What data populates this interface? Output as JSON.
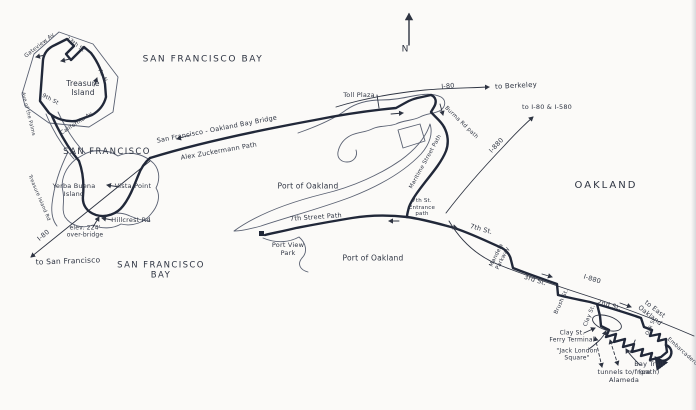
{
  "colors": {
    "paper": "#fbfaf8",
    "ink": "#2e3442",
    "route": "#212839",
    "thin": "#5a6172"
  },
  "map": {
    "type": "hand-drawn bicycle route map, SF Bay Bridge / Oakland",
    "labels": [
      {
        "name": "sf-bay-north",
        "text": "SAN FRANCISCO BAY",
        "x": 203,
        "y": 60,
        "rot": 0,
        "size": 9,
        "ls": 1.6
      },
      {
        "name": "san-francisco",
        "text": "SAN FRANCISCO",
        "x": 107,
        "y": 152,
        "rot": 0,
        "size": 8.5,
        "ls": 1.4
      },
      {
        "name": "sf-bay-south",
        "text": "SAN FRANCISCO\nBAY",
        "x": 161,
        "y": 271,
        "rot": 0,
        "size": 8.5,
        "ls": 1.4
      },
      {
        "name": "oakland",
        "text": "OAKLAND",
        "x": 606,
        "y": 186,
        "rot": 0,
        "size": 10,
        "ls": 2
      },
      {
        "name": "port-of-oakland-upper",
        "text": "Port of Oakland",
        "x": 308,
        "y": 186,
        "rot": 0,
        "size": 7.5
      },
      {
        "name": "port-of-oakland-lower",
        "text": "Port of Oakland",
        "x": 373,
        "y": 258,
        "rot": 0,
        "size": 7.5
      },
      {
        "name": "treasure-island",
        "text": "Treasure\nIsland",
        "x": 83,
        "y": 88,
        "rot": 0,
        "size": 7.5
      },
      {
        "name": "gateview-av",
        "text": "Gateview Av",
        "x": 40,
        "y": 46,
        "rot": -38,
        "size": 5.5
      },
      {
        "name": "thirteenth-st",
        "text": "13th St",
        "x": 75,
        "y": 45,
        "rot": 36,
        "size": 5.5
      },
      {
        "name": "av-n",
        "text": "Av N",
        "x": 102,
        "y": 76,
        "rot": 62,
        "size": 5.5
      },
      {
        "name": "ninth-st",
        "text": "9th St",
        "x": 50,
        "y": 100,
        "rot": 28,
        "size": 5.5
      },
      {
        "name": "california-av",
        "text": "California Av",
        "x": 77,
        "y": 124,
        "rot": -33,
        "size": 5.5
      },
      {
        "name": "ave-of-the-palms",
        "text": "Ave of the Palms",
        "x": 28,
        "y": 114,
        "rot": 76,
        "size": 5
      },
      {
        "name": "treasure-island-rd",
        "text": "Treasure Island Rd",
        "x": 39,
        "y": 198,
        "rot": 67,
        "size": 5
      },
      {
        "name": "yerba-buena-island",
        "text": "Yerba Buena\nIsland",
        "x": 74,
        "y": 191,
        "rot": 0,
        "size": 6.5
      },
      {
        "name": "vista-point",
        "text": "Vista Point",
        "x": 133,
        "y": 187,
        "rot": 0,
        "size": 6.5
      },
      {
        "name": "hillcrest-rd",
        "text": "Hillcrest Rd",
        "x": 131,
        "y": 221,
        "rot": 0,
        "size": 6.5
      },
      {
        "name": "elevation",
        "text": "elev. 224'\nover-bridge",
        "x": 85,
        "y": 232,
        "rot": 0,
        "size": 6
      },
      {
        "name": "i80-west",
        "text": "I-80",
        "x": 44,
        "y": 236,
        "rot": -40,
        "size": 6.5
      },
      {
        "name": "to-san-francisco",
        "text": "to San Francisco",
        "x": 68,
        "y": 261,
        "rot": -2,
        "size": 7.5
      },
      {
        "name": "bay-bridge",
        "text": "San Francisco - Oakland Bay Bridge",
        "x": 217,
        "y": 130,
        "rot": -11,
        "size": 6.5
      },
      {
        "name": "zuckermann-path",
        "text": "Alex Zuckermann Path",
        "x": 219,
        "y": 152,
        "rot": -10,
        "size": 6.5
      },
      {
        "name": "toll-plaza",
        "text": "Toll Plaza",
        "x": 359,
        "y": 96,
        "rot": 0,
        "size": 6.5
      },
      {
        "name": "i80-east",
        "text": "I-80",
        "x": 448,
        "y": 87,
        "rot": -5,
        "size": 6.5
      },
      {
        "name": "to-berkeley",
        "text": "to Berkeley",
        "x": 516,
        "y": 86,
        "rot": -3,
        "size": 7
      },
      {
        "name": "to-i80-i580",
        "text": "to I-80 & I-580",
        "x": 547,
        "y": 108,
        "rot": 0,
        "size": 6.5
      },
      {
        "name": "i880-north",
        "text": "I-880",
        "x": 497,
        "y": 146,
        "rot": -47,
        "size": 6.5
      },
      {
        "name": "burma-rd-path",
        "text": "Burma Rd path",
        "x": 461,
        "y": 123,
        "rot": 44,
        "size": 5.5
      },
      {
        "name": "maritime-street-path",
        "text": "Maritime Street Path",
        "x": 426,
        "y": 162,
        "rot": -61,
        "size": 5.5
      },
      {
        "name": "seventh-st-entrance",
        "text": "7th St.\nEntrance\npath",
        "x": 422,
        "y": 208,
        "rot": 0,
        "size": 5.5
      },
      {
        "name": "seventh-street-path",
        "text": "7th Street Path",
        "x": 316,
        "y": 218,
        "rot": -4,
        "size": 6.5
      },
      {
        "name": "port-view-park",
        "text": "Port View\nPark",
        "x": 288,
        "y": 250,
        "rot": 0,
        "size": 6.5
      },
      {
        "name": "seventh-st",
        "text": "7th St.",
        "x": 481,
        "y": 230,
        "rot": 16,
        "size": 6.5
      },
      {
        "name": "mandela-parkway",
        "text": "Mandela\nParkway",
        "x": 500,
        "y": 257,
        "rot": -64,
        "size": 5.5
      },
      {
        "name": "third-st",
        "text": "3rd St.",
        "x": 535,
        "y": 281,
        "rot": 17,
        "size": 6.5
      },
      {
        "name": "i880-south",
        "text": "I-880",
        "x": 592,
        "y": 280,
        "rot": 17,
        "size": 6.5
      },
      {
        "name": "brush-st",
        "text": "Brush St.",
        "x": 562,
        "y": 302,
        "rot": -65,
        "size": 5.5
      },
      {
        "name": "second-st",
        "text": "2nd St.",
        "x": 609,
        "y": 306,
        "rot": 16,
        "size": 6.5
      },
      {
        "name": "to-east-oakland",
        "text": "to East Oakland",
        "x": 652,
        "y": 313,
        "rot": 38,
        "size": 6.5
      },
      {
        "name": "clay-st",
        "text": "Clay St.",
        "x": 590,
        "y": 316,
        "rot": -68,
        "size": 5.5
      },
      {
        "name": "clay-st-ferry-terminal",
        "text": "Clay St.\nFerry Terminal",
        "x": 572,
        "y": 337,
        "rot": 0,
        "size": 6
      },
      {
        "name": "jack-london-square",
        "text": "\"Jack London\nSquare\"",
        "x": 577,
        "y": 355,
        "rot": 0,
        "size": 6
      },
      {
        "name": "oak-st",
        "text": "Oak St",
        "x": 651,
        "y": 327,
        "rot": -65,
        "size": 5
      },
      {
        "name": "embarcadero",
        "text": "Embarcadero",
        "x": 682,
        "y": 352,
        "rot": 42,
        "size": 5.5
      },
      {
        "name": "bay-trail-path",
        "text": "Bay Trail (path)",
        "x": 649,
        "y": 369,
        "rot": 0,
        "size": 6.5
      },
      {
        "name": "tunnels-alameda",
        "text": "tunnels to/from\nAlameda",
        "x": 624,
        "y": 377,
        "rot": 0,
        "size": 6.5
      },
      {
        "name": "compass-n",
        "text": "N",
        "x": 405,
        "y": 50,
        "rot": 0,
        "size": 9,
        "ls": 0
      }
    ]
  }
}
